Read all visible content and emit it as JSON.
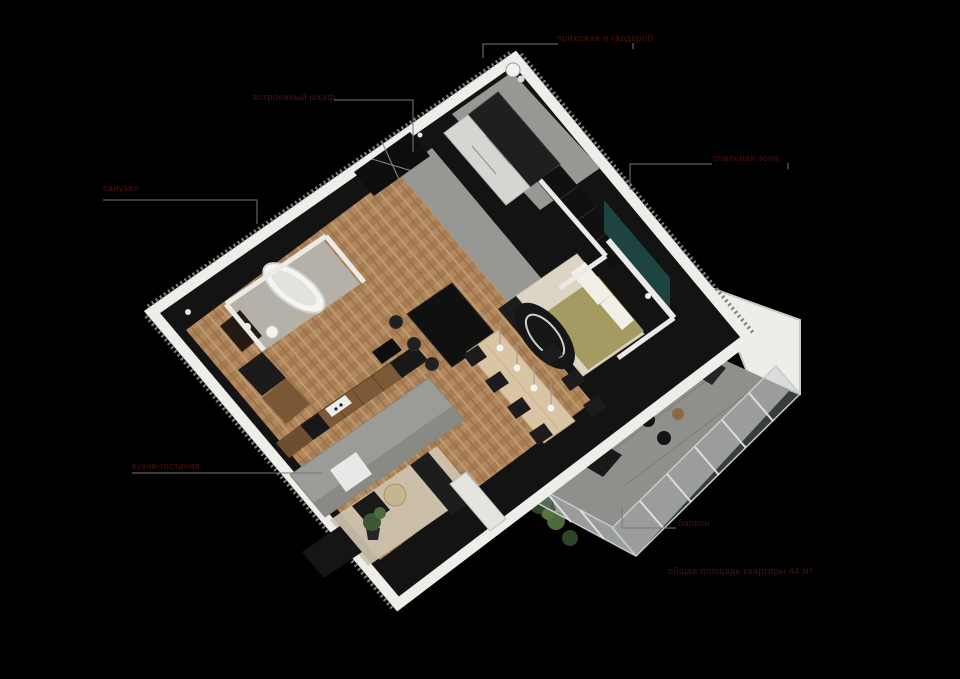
{
  "canvas": {
    "width": 960,
    "height": 679,
    "background": "#000000"
  },
  "labels": [
    {
      "id": "entry",
      "text": "прихожая и гардероб"
    },
    {
      "id": "wardrobe",
      "text": "встроенный шкаф"
    },
    {
      "id": "bathroom",
      "text": "санузел"
    },
    {
      "id": "bedroom",
      "text": "спальная зона"
    },
    {
      "id": "livingroom",
      "text": "кухня-гостиная"
    },
    {
      "id": "balcony",
      "text": "балкон"
    },
    {
      "id": "total-area",
      "text": "общая площадь квартиры 44 м²"
    }
  ],
  "colors": {
    "background": "#000000",
    "label_text": "#4a1210",
    "leader_line": "#777777",
    "wall_white": "#efeeea",
    "floor_wood": "#b08a63",
    "floor_concrete": "#979793",
    "accent_teal": "#1d4440",
    "bed_blanket": "#a59a62",
    "furniture_dark": "#1a1a1a",
    "cabinet_wood": "#7a5836",
    "table_wood": "#d9c4a4",
    "sofa_gray": "#9b9b97",
    "plant_green": "#46613a",
    "balcony_glass": "#aeb6b8"
  }
}
